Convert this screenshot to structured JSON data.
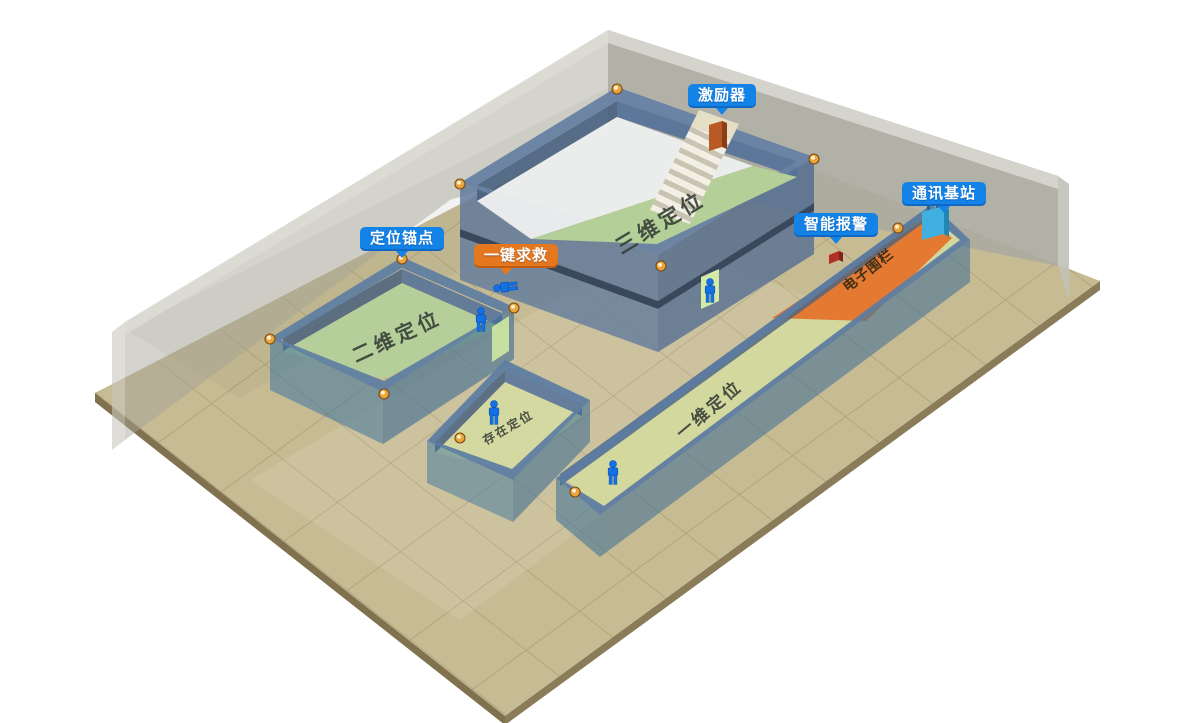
{
  "callouts": [
    {
      "id": "exciter",
      "label": "激励器",
      "style": "blue"
    },
    {
      "id": "comm-base-station",
      "label": "通讯基站",
      "style": "blue"
    },
    {
      "id": "smart-alarm",
      "label": "智能报警",
      "style": "blue"
    },
    {
      "id": "positioning-anchor",
      "label": "定位锚点",
      "style": "blue"
    },
    {
      "id": "one-key-sos",
      "label": "一键求救",
      "style": "orange"
    }
  ],
  "zones": [
    {
      "id": "zone-3d",
      "label": "三维定位"
    },
    {
      "id": "zone-2d",
      "label": "二维定位"
    },
    {
      "id": "zone-presence",
      "label": "存在定位"
    },
    {
      "id": "zone-1d",
      "label": "一维定位"
    },
    {
      "id": "electronic-fence",
      "label": "电子围栏"
    }
  ],
  "colors": {
    "badge_blue": "#1483e8",
    "badge_orange": "#e5781e",
    "fence_orange": "#e5752c",
    "floor_tan": "#c7bb94",
    "room_green": "#b5ce99",
    "corridor_green": "#d3d89e",
    "wall_blue": "#5d7ca2",
    "back_wall_gray": "#acaba0",
    "person_blue": "#1470e6",
    "anchor_amber": "#e9a43c"
  }
}
